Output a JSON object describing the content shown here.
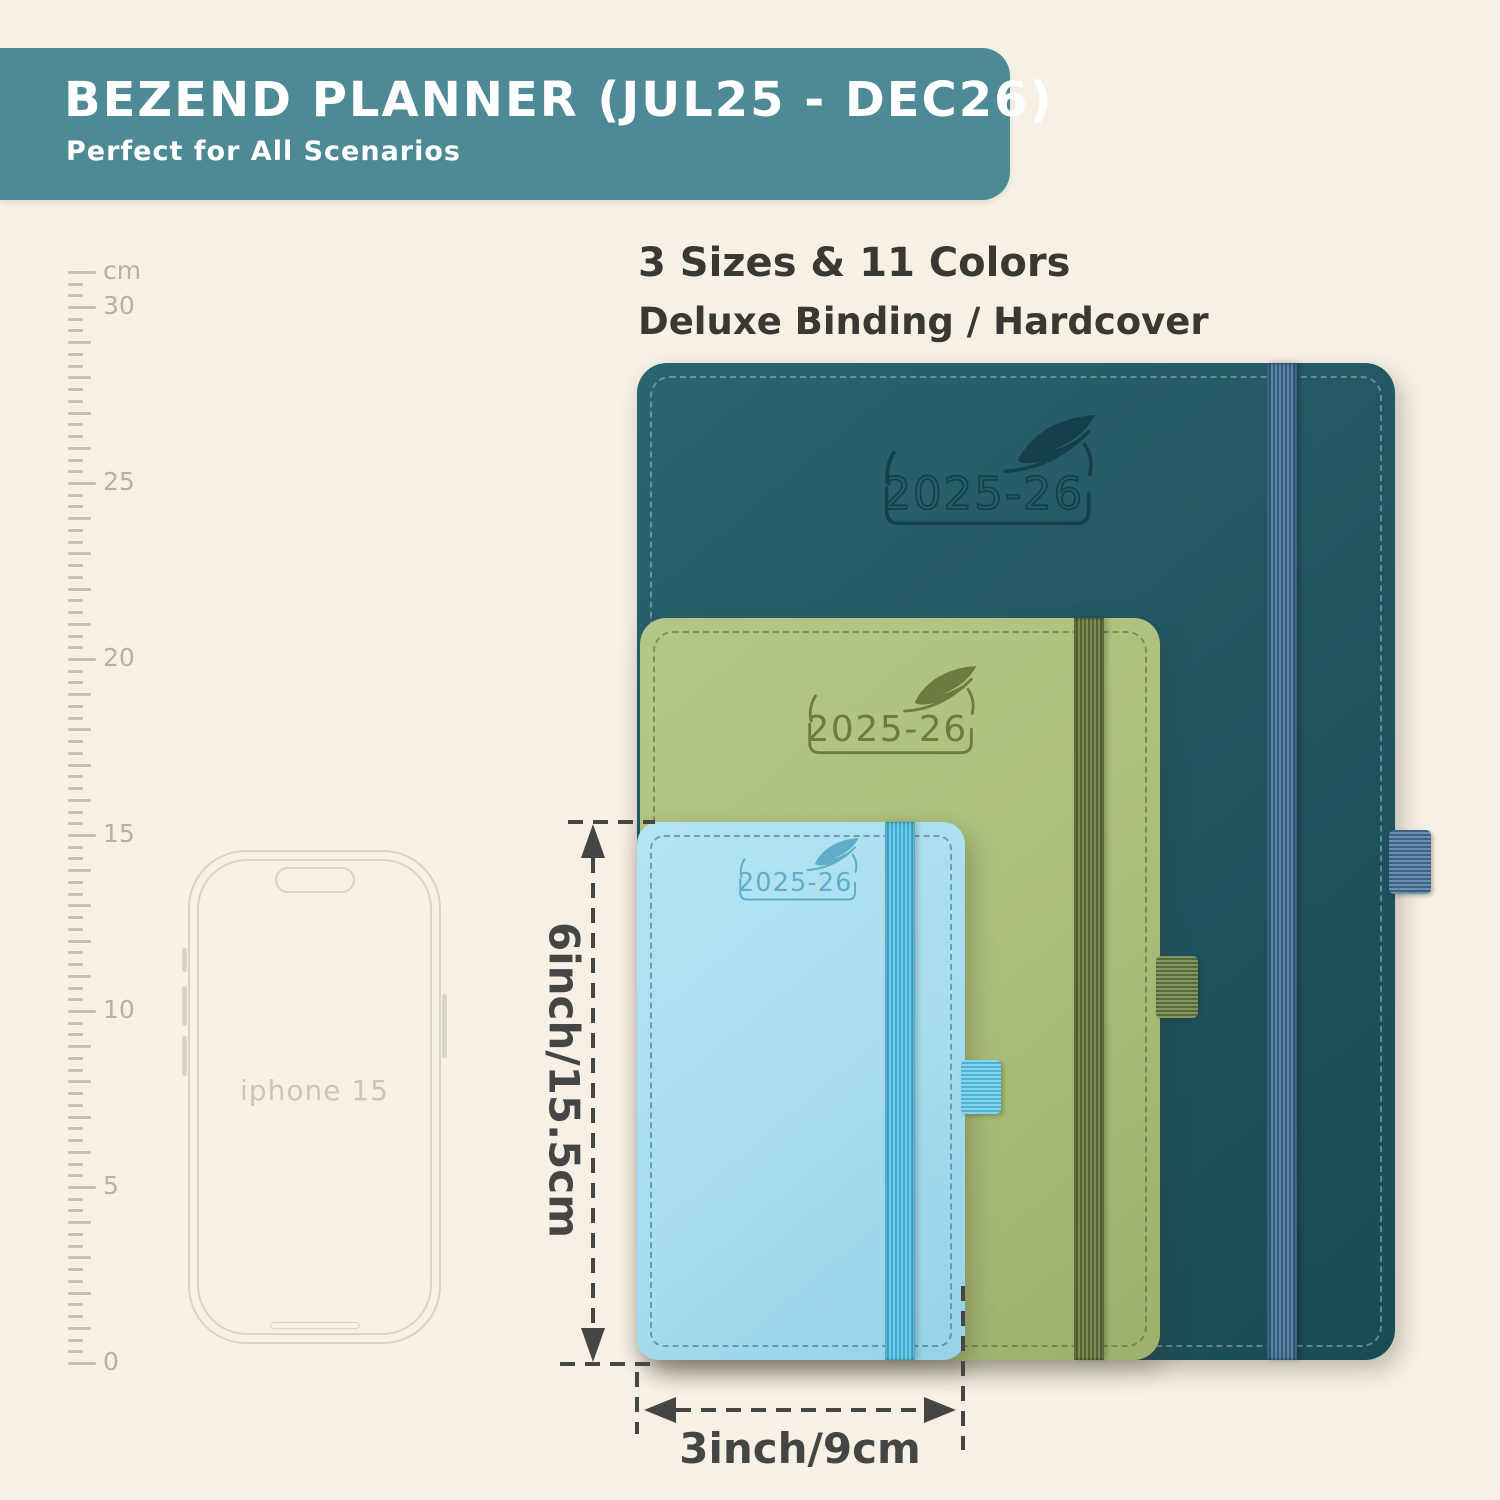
{
  "header": {
    "title": "BEZEND PLANNER (JUL25 - DEC26)",
    "subtitle": "Perfect for All Scenarios"
  },
  "features": {
    "line1": "3 Sizes & 11 Colors",
    "line2": "Deluxe Binding / Hardcover"
  },
  "ruler": {
    "unit_label": "cm",
    "labels": {
      "31": "cm",
      "30": "30",
      "25": "25",
      "20": "20",
      "15": "15",
      "10": "10",
      "5": "5",
      "0": "0"
    }
  },
  "phone": {
    "label": "iphone 15"
  },
  "planners": [
    {
      "name": "large-teal-planner",
      "year_label": "2025-26"
    },
    {
      "name": "medium-green-planner",
      "year_label": "2025-26"
    },
    {
      "name": "small-blue-planner",
      "year_label": "2025-26"
    }
  ],
  "dimensions": {
    "height_label": "6inch/15.5cm",
    "width_label": "3inch/9cm"
  },
  "colors": {
    "background": "#f6f1e4",
    "banner_bg": "#4e8a96",
    "banner_text": "#ffffff",
    "text_dark": "#3a3832",
    "dim_color": "#454545",
    "ruler_tick": "#c6c1b2",
    "ruler_label": "#b6b1a2",
    "phone_line": "#d8d4c6",
    "phone_text": "#cbc6b6",
    "cover_teal": "#20545f",
    "cover_teal_light": "#2a6570",
    "emboss_teal": "#143f4b",
    "band_teal": "#3e6f95",
    "loop_teal": "#49799f",
    "stitch_teal": "#c8dcd666",
    "cover_green": "#abbe79",
    "cover_green_light": "#b5c786",
    "emboss_green": "#6d7b40",
    "band_green": "#68793e",
    "loop_green": "#6f8346",
    "stitch_green": "#4f5f2b80",
    "cover_blue": "#a7ddef",
    "cover_blue_light": "#b4e4f3",
    "emboss_blue": "#5fadc9",
    "band_blue": "#49c1e9",
    "loop_blue": "#58c9ec",
    "stitch_blue": "#1d637d80"
  }
}
